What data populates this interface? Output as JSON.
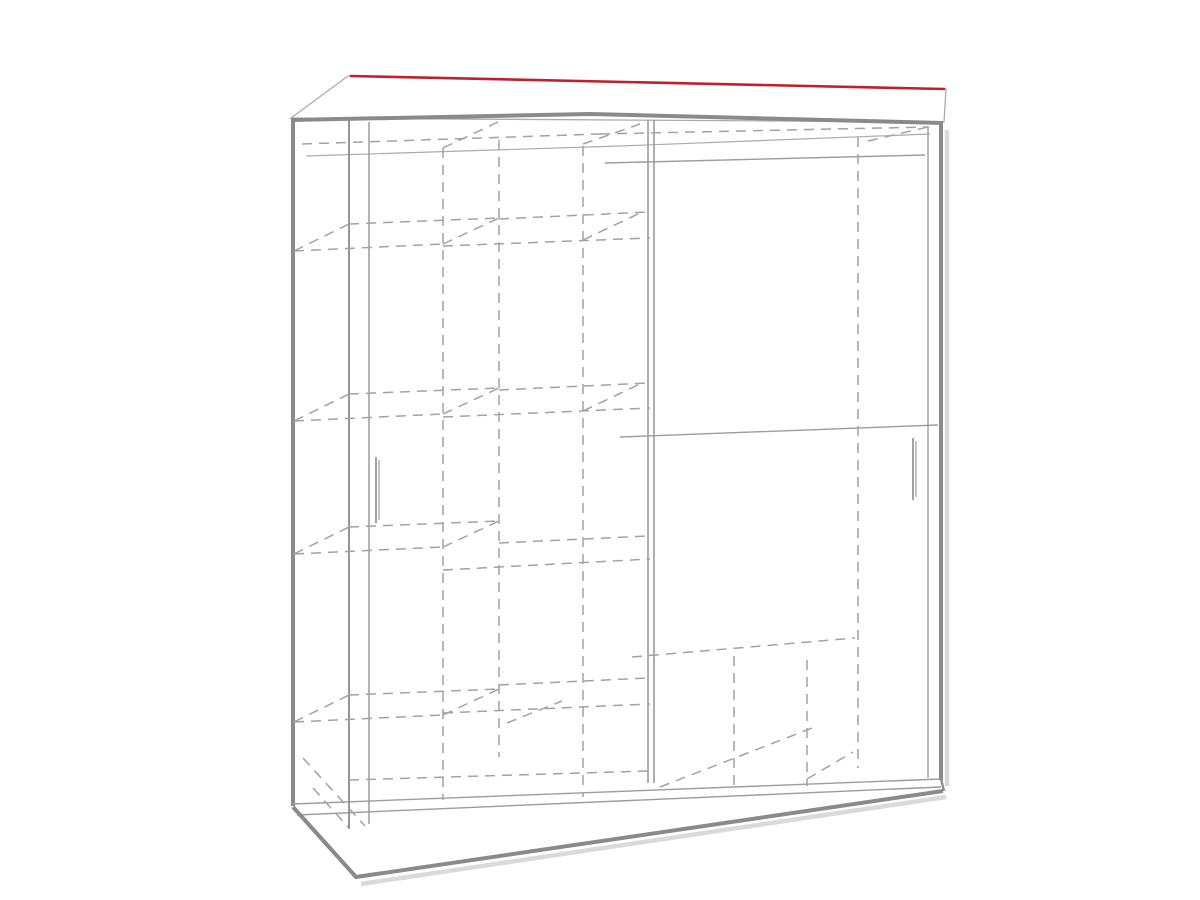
{
  "page": {
    "background": "#ffffff",
    "figure_type": "wardrobe-dimension-diagram"
  },
  "colors": {
    "red": "#c0202c",
    "edge": "#8a8a8a",
    "line": "#9c9c9c",
    "faint": "#ababab",
    "dash": "#a2a2a2",
    "shadow": "#dadada",
    "text": "#242424",
    "bg": "#ffffff"
  },
  "dimensions": [
    {
      "id": "width-200",
      "num": "200",
      "unit": "cm",
      "text": "200cm",
      "label": {
        "x": 630,
        "y": 61,
        "rotate": 1,
        "size": 36
      },
      "line": [
        350,
        76,
        945,
        89
      ],
      "ext": []
    },
    {
      "id": "depth-62",
      "num": "62",
      "unit": "cm",
      "text": "62cm",
      "label": {
        "x": 304,
        "y": 64,
        "rotate": -16,
        "size": 32
      },
      "line": [
        287,
        91,
        347,
        77
      ],
      "ext": [
        {
          "p": [
            287,
            91,
            287,
            118
          ],
          "c": "red",
          "w": 2.4
        }
      ]
    },
    {
      "id": "height-215",
      "num": "215",
      "unit": "cm",
      "text": "215cm",
      "label": {
        "x": 237,
        "y": 458,
        "rotate": -90,
        "size": 36
      },
      "line": [
        258,
        117,
        258,
        805
      ],
      "ext": [
        {
          "p": [
            258,
            117,
            291,
            117
          ],
          "c": "line",
          "w": 1.2
        },
        {
          "p": [
            258,
            805,
            293,
            805
          ],
          "c": "line",
          "w": 1.2
        }
      ]
    },
    {
      "id": "shelf-42-top",
      "num": "42",
      "unit": "cm",
      "text": "42cm",
      "label": {
        "x": 433,
        "y": 179,
        "rotate": 90,
        "size": 31
      },
      "line": [
        418,
        120,
        418,
        242
      ],
      "ext": []
    },
    {
      "id": "shelf-42-second",
      "num": "42",
      "unit": "cm",
      "text": "42cm",
      "label": {
        "x": 562,
        "y": 328,
        "rotate": 90,
        "size": 31
      },
      "line": [
        546,
        243,
        546,
        411
      ],
      "ext": []
    },
    {
      "id": "shelf-width-48-upper",
      "num": "48",
      "unit": "cm",
      "text": "48cm",
      "label": {
        "x": 411,
        "y": 398,
        "rotate": -2,
        "size": 31
      },
      "line": [
        347,
        419,
        498,
        413
      ],
      "ext": []
    },
    {
      "id": "shelf-42-third",
      "num": "42",
      "unit": "cm",
      "text": "42cm",
      "label": {
        "x": 432,
        "y": 500,
        "rotate": 90,
        "size": 31
      },
      "line": [
        419,
        419,
        419,
        571
      ],
      "ext": []
    },
    {
      "id": "shelf-width-48-middle",
      "num": "48",
      "unit": "cm",
      "text": "48cm",
      "label": {
        "x": 568,
        "y": 547,
        "rotate": -3,
        "size": 31
      },
      "line": [
        497,
        566,
        650,
        556
      ],
      "ext": []
    },
    {
      "id": "shelf-42-fourth",
      "num": "42",
      "unit": "cm",
      "text": "42cm",
      "label": {
        "x": 562,
        "y": 633,
        "rotate": 90,
        "size": 31
      },
      "line": [
        547,
        568,
        547,
        704
      ],
      "ext": []
    },
    {
      "id": "door-section-78",
      "num": "78",
      "unit": "cm",
      "text": "78cm",
      "label": {
        "x": 797,
        "y": 295,
        "rotate": 90,
        "size": 31
      },
      "line": [
        782,
        160,
        782,
        434
      ],
      "ext": []
    },
    {
      "id": "door-section-82",
      "num": "82",
      "unit": "cm",
      "text": "82cm",
      "label": {
        "x": 699,
        "y": 551,
        "rotate": 90,
        "size": 31
      },
      "line": [
        685,
        440,
        685,
        653
      ],
      "ext": []
    },
    {
      "id": "bottom-width-97",
      "num": "97",
      "unit": "cm",
      "text": "97cm",
      "label": {
        "x": 788,
        "y": 663,
        "rotate": -5,
        "size": 31
      },
      "line": [
        655,
        695,
        942,
        668
      ],
      "ext": []
    },
    {
      "id": "bottom-right-30",
      "num": "30",
      "unit": "cm",
      "text": "30cm",
      "label": {
        "x": 897,
        "y": 722,
        "rotate": 90,
        "size": 31
      },
      "line": [
        882,
        676,
        882,
        765
      ],
      "ext": []
    },
    {
      "id": "bottom-shelf-48",
      "num": "48",
      "unit": "cm",
      "text": "48cm",
      "label": {
        "x": 718,
        "y": 769,
        "rotate": -7,
        "size": 31
      },
      "line": [
        657,
        790,
        805,
        777
      ],
      "ext": []
    },
    {
      "id": "bottom-depth-52",
      "num": "52",
      "unit": "cm",
      "text": "52cm",
      "label": {
        "x": 563,
        "y": 760,
        "rotate": 37,
        "size": 31
      },
      "line": [
        525,
        758,
        577,
        793
      ],
      "ext": []
    },
    {
      "id": "bottom-left-30",
      "num": "30",
      "unit": "cm",
      "text": "30cm",
      "label": {
        "x": 418,
        "y": 768,
        "rotate": 90,
        "size": 31
      },
      "line": [
        397,
        718,
        397,
        817
      ],
      "ext": []
    }
  ],
  "structure": {
    "top_panel": "291,118 348,76 946,89 944,122",
    "shadows": [
      {
        "p": [
          947,
          130,
          947,
          786
        ],
        "w": 4.5
      },
      {
        "p": [
          361,
          884,
          946,
          797
        ],
        "w": 4.5
      }
    ],
    "solid": [
      {
        "p": [
          291,
          120,
          590,
          114,
          943,
          123
        ],
        "w": 4,
        "c": "edge"
      },
      {
        "p": [
          293,
          121,
          293,
          806
        ],
        "w": 4,
        "c": "edge"
      },
      {
        "p": [
          941,
          123,
          941,
          780
        ],
        "w": 4,
        "c": "edge"
      },
      {
        "p": [
          293,
          804,
          941,
          779
        ],
        "w": 1.4,
        "c": "line"
      },
      {
        "p": [
          297,
          815,
          941,
          787
        ],
        "w": 1.4,
        "c": "line"
      },
      {
        "p": [
          293,
          807,
          356,
          877,
          943,
          791
        ],
        "w": 4,
        "c": "edge"
      },
      {
        "p": [
          941,
          779,
          944,
          791
        ],
        "w": 2.4,
        "c": "edge"
      },
      {
        "p": [
          306,
          156,
          620,
          146,
          930,
          134
        ],
        "w": 1.2,
        "c": "faint"
      },
      {
        "p": [
          605,
          163,
          925,
          155
        ],
        "w": 1.4,
        "c": "line"
      },
      {
        "p": [
          620,
          437,
          938,
          425
        ],
        "w": 1.4,
        "c": "line"
      },
      {
        "p": [
          349,
          120,
          349,
          829
        ],
        "w": 1.8,
        "c": "edge"
      },
      {
        "p": [
          369,
          122,
          369,
          824
        ],
        "w": 1.5,
        "c": "line"
      },
      {
        "p": [
          648,
          120,
          648,
          783
        ],
        "w": 1.6,
        "c": "line"
      },
      {
        "p": [
          654,
          120,
          654,
          783
        ],
        "w": 1.6,
        "c": "line"
      },
      {
        "p": [
          928,
          126,
          928,
          778
        ],
        "w": 1.4,
        "c": "line"
      },
      {
        "p": [
          376,
          457,
          376,
          523
        ],
        "w": 1.6,
        "c": "edge"
      },
      {
        "p": [
          379,
          460,
          379,
          520
        ],
        "w": 1.2,
        "c": "line"
      },
      {
        "p": [
          913,
          438,
          913,
          500
        ],
        "w": 1.6,
        "c": "edge"
      },
      {
        "p": [
          916,
          441,
          916,
          497
        ],
        "w": 1.2,
        "c": "line"
      }
    ],
    "dashed": [
      [
        302,
        144,
        600,
        134
      ],
      [
        600,
        134,
        927,
        127
      ],
      [
        443,
        148,
        443,
        800
      ],
      [
        499,
        140,
        499,
        757
      ],
      [
        583,
        146,
        583,
        797
      ],
      [
        858,
        137,
        858,
        768
      ],
      [
        734,
        656,
        734,
        792
      ],
      [
        807,
        660,
        807,
        786
      ],
      [
        294,
        251,
        443,
        244
      ],
      [
        294,
        421,
        443,
        414
      ],
      [
        294,
        554,
        443,
        547
      ],
      [
        294,
        722,
        443,
        715
      ],
      [
        349,
        224,
        499,
        218
      ],
      [
        349,
        394,
        499,
        388
      ],
      [
        349,
        527,
        499,
        521
      ],
      [
        349,
        695,
        499,
        689
      ],
      [
        294,
        251,
        349,
        224
      ],
      [
        294,
        421,
        349,
        394
      ],
      [
        294,
        554,
        349,
        527
      ],
      [
        294,
        722,
        349,
        695
      ],
      [
        443,
        244,
        499,
        218
      ],
      [
        443,
        414,
        499,
        388
      ],
      [
        443,
        547,
        499,
        521
      ],
      [
        443,
        715,
        499,
        689
      ],
      [
        443,
        246,
        650,
        238
      ],
      [
        443,
        417,
        650,
        408
      ],
      [
        443,
        570,
        650,
        559
      ],
      [
        443,
        713,
        650,
        704
      ],
      [
        499,
        219,
        648,
        212
      ],
      [
        499,
        390,
        648,
        383
      ],
      [
        499,
        543,
        648,
        536
      ],
      [
        499,
        685,
        648,
        678
      ],
      [
        583,
        144,
        640,
        124
      ],
      [
        583,
        240,
        638,
        214
      ],
      [
        583,
        411,
        638,
        385
      ],
      [
        443,
        148,
        498,
        122
      ],
      [
        868,
        141,
        928,
        127
      ],
      [
        632,
        657,
        855,
        638
      ],
      [
        807,
        779,
        853,
        752
      ],
      [
        660,
        787,
        812,
        728
      ],
      [
        303,
        758,
        365,
        826
      ],
      [
        313,
        788,
        348,
        827
      ],
      [
        349,
        780,
        648,
        771
      ],
      [
        507,
        723,
        562,
        701
      ]
    ]
  }
}
